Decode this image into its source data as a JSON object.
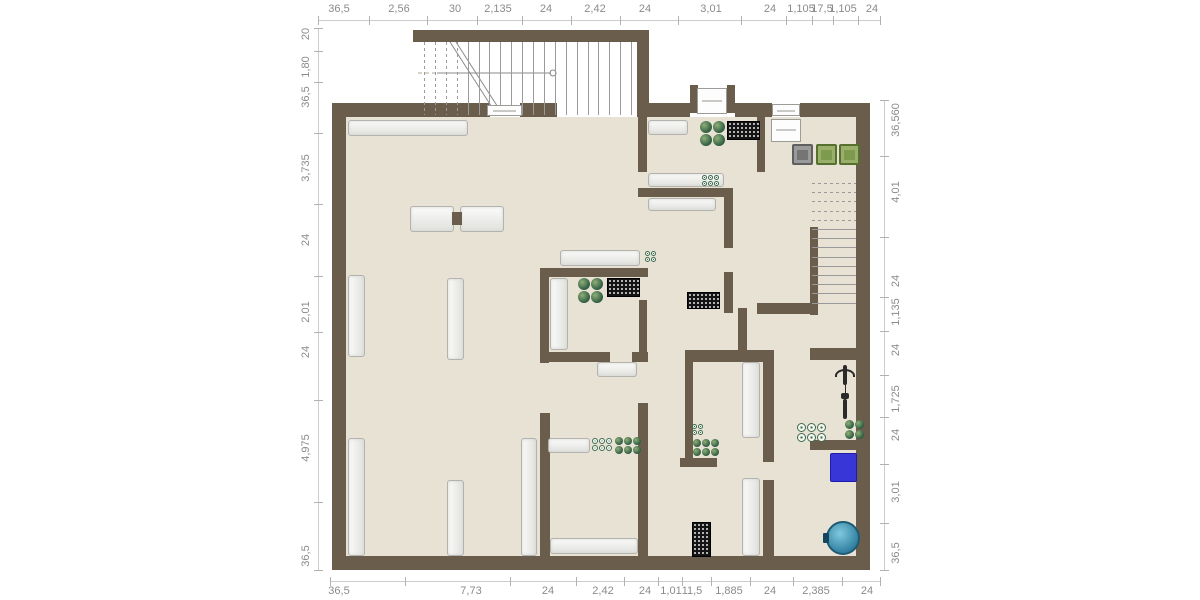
{
  "meta": {
    "watermark": "Illustration@ImmoGrafik"
  },
  "colors": {
    "wall": "#6a5d4b",
    "floor": "#e7e2d4",
    "dim_text": "#8b8b8b",
    "plant_green": "#2e5c41",
    "mat_black": "#141414",
    "chair_gray": "#7d7d7d",
    "chair_green": "#7e9a4e",
    "tank_blue": "#3936d8",
    "barrel_teal": "#2e7d9e"
  },
  "dimensions": {
    "top": {
      "line": {
        "x1": 318,
        "x2": 880,
        "y": 20
      },
      "labels": [
        {
          "t": "36,5",
          "p": 339
        },
        {
          "t": "2,56",
          "p": 399
        },
        {
          "t": "30",
          "p": 455
        },
        {
          "t": "2,135",
          "p": 498
        },
        {
          "t": "24",
          "p": 546
        },
        {
          "t": "2,42",
          "p": 595
        },
        {
          "t": "24",
          "p": 645
        },
        {
          "t": "3,01",
          "p": 711
        },
        {
          "t": "24",
          "p": 770
        },
        {
          "t": "1,105",
          "p": 801
        },
        {
          "t": "17,5",
          "p": 822
        },
        {
          "t": "1,105",
          "p": 843
        },
        {
          "t": "24",
          "p": 872
        }
      ]
    },
    "bottom": {
      "line": {
        "x1": 330,
        "x2": 880,
        "y": 581
      },
      "labels": [
        {
          "t": "36,5",
          "p": 339
        },
        {
          "t": "7,73",
          "p": 471
        },
        {
          "t": "24",
          "p": 548
        },
        {
          "t": "2,42",
          "p": 603
        },
        {
          "t": "24",
          "p": 645
        },
        {
          "t": "1,01",
          "p": 671
        },
        {
          "t": "11,5",
          "p": 692
        },
        {
          "t": "1,885",
          "p": 729
        },
        {
          "t": "24",
          "p": 770
        },
        {
          "t": "2,385",
          "p": 816
        },
        {
          "t": "24",
          "p": 867
        }
      ]
    },
    "left": {
      "line": {
        "y1": 28,
        "y2": 570,
        "x": 318
      },
      "labels": [
        {
          "t": "20",
          "p": 34
        },
        {
          "t": "1,80",
          "p": 67
        },
        {
          "t": "36,5",
          "p": 97
        },
        {
          "t": "3,735",
          "p": 168
        },
        {
          "t": "24",
          "p": 240
        },
        {
          "t": "2,01",
          "p": 312
        },
        {
          "t": "24",
          "p": 352
        },
        {
          "t": "4,975",
          "p": 448
        },
        {
          "t": "36,5",
          "p": 556
        }
      ]
    },
    "right": {
      "line": {
        "y1": 100,
        "y2": 570,
        "x": 884
      },
      "labels": [
        {
          "t": "36,560",
          "p": 120
        },
        {
          "t": "4,01",
          "p": 192
        },
        {
          "t": "24",
          "p": 281
        },
        {
          "t": "1,135",
          "p": 312
        },
        {
          "t": "24",
          "p": 350
        },
        {
          "t": "1,725",
          "p": 399
        },
        {
          "t": "24",
          "p": 435
        },
        {
          "t": "3,01",
          "p": 492
        },
        {
          "t": "36,5",
          "p": 553
        }
      ]
    }
  },
  "plan": {
    "floor": [
      [
        346,
        117,
        510,
        439
      ]
    ],
    "walls": [
      [
        332,
        103,
        14,
        467
      ],
      [
        332,
        556,
        538,
        14
      ],
      [
        856,
        103,
        14,
        467
      ],
      [
        332,
        103,
        158,
        14
      ],
      [
        520,
        103,
        37,
        14
      ],
      [
        637,
        103,
        53,
        14
      ],
      [
        735,
        103,
        37,
        14
      ],
      [
        800,
        103,
        56,
        14
      ],
      [
        413,
        30,
        236,
        12
      ],
      [
        637,
        42,
        12,
        75
      ],
      [
        690,
        85,
        8,
        28
      ],
      [
        727,
        85,
        8,
        28
      ],
      [
        638,
        117,
        9,
        55
      ],
      [
        638,
        188,
        95,
        9
      ],
      [
        724,
        188,
        9,
        60
      ],
      [
        724,
        272,
        9,
        41
      ],
      [
        540,
        268,
        108,
        9
      ],
      [
        540,
        268,
        9,
        95
      ],
      [
        548,
        352,
        62,
        10
      ],
      [
        632,
        352,
        16,
        10
      ],
      [
        639,
        300,
        8,
        52
      ],
      [
        540,
        413,
        10,
        143
      ],
      [
        638,
        403,
        10,
        153
      ],
      [
        685,
        350,
        89,
        12
      ],
      [
        685,
        362,
        8,
        98
      ],
      [
        680,
        458,
        37,
        9
      ],
      [
        763,
        350,
        11,
        112
      ],
      [
        763,
        480,
        11,
        76
      ],
      [
        810,
        348,
        46,
        12
      ],
      [
        810,
        440,
        46,
        10
      ],
      [
        757,
        303,
        61,
        11
      ],
      [
        810,
        227,
        8,
        88
      ],
      [
        757,
        117,
        8,
        55
      ],
      [
        738,
        308,
        9,
        46
      ]
    ],
    "furniture": [
      {
        "x": 348,
        "y": 120,
        "w": 120,
        "h": 16
      },
      {
        "x": 410,
        "y": 206,
        "w": 44,
        "h": 26
      },
      {
        "x": 460,
        "y": 206,
        "w": 44,
        "h": 26
      },
      {
        "x": 348,
        "y": 275,
        "w": 17,
        "h": 82,
        "v": 1
      },
      {
        "x": 447,
        "y": 278,
        "w": 17,
        "h": 82,
        "v": 1
      },
      {
        "x": 348,
        "y": 438,
        "w": 17,
        "h": 118,
        "v": 1
      },
      {
        "x": 447,
        "y": 480,
        "w": 17,
        "h": 76,
        "v": 1
      },
      {
        "x": 521,
        "y": 438,
        "w": 16,
        "h": 118,
        "v": 1
      },
      {
        "x": 550,
        "y": 538,
        "w": 88,
        "h": 16
      },
      {
        "x": 548,
        "y": 438,
        "w": 42,
        "h": 15
      },
      {
        "x": 560,
        "y": 250,
        "w": 80,
        "h": 16
      },
      {
        "x": 550,
        "y": 278,
        "w": 18,
        "h": 72,
        "v": 1
      },
      {
        "x": 648,
        "y": 120,
        "w": 40,
        "h": 15
      },
      {
        "x": 648,
        "y": 173,
        "w": 76,
        "h": 14
      },
      {
        "x": 648,
        "y": 198,
        "w": 68,
        "h": 13
      },
      {
        "x": 597,
        "y": 362,
        "w": 40,
        "h": 15
      },
      {
        "x": 742,
        "y": 362,
        "w": 18,
        "h": 76,
        "v": 1
      },
      {
        "x": 742,
        "y": 478,
        "w": 18,
        "h": 78,
        "v": 1
      }
    ],
    "island_link": {
      "x": 452,
      "y": 212,
      "w": 10,
      "h": 13
    },
    "fixtures": [
      {
        "x": 487,
        "y": 105,
        "w": 35,
        "h": 11
      },
      {
        "x": 697,
        "y": 88,
        "w": 30,
        "h": 26
      },
      {
        "x": 772,
        "y": 104,
        "w": 28,
        "h": 12
      },
      {
        "x": 771,
        "y": 119,
        "w": 30,
        "h": 23
      }
    ],
    "mats": [
      {
        "x": 727,
        "y": 121,
        "w": 31,
        "h": 17
      },
      {
        "x": 607,
        "y": 278,
        "w": 31,
        "h": 17
      },
      {
        "x": 687,
        "y": 292,
        "w": 31,
        "h": 15
      },
      {
        "x": 692,
        "y": 522,
        "w": 17,
        "h": 33
      }
    ],
    "plants": [
      {
        "x": 700,
        "y": 121,
        "rows": 2,
        "cols": 2,
        "size": 12,
        "variant": "dark"
      },
      {
        "x": 578,
        "y": 278,
        "rows": 2,
        "cols": 2,
        "size": 12,
        "variant": "dark"
      },
      {
        "x": 693,
        "y": 439,
        "rows": 2,
        "cols": 3,
        "size": 8,
        "variant": "dark"
      },
      {
        "x": 615,
        "y": 437,
        "rows": 2,
        "cols": 3,
        "size": 8,
        "variant": "dark"
      },
      {
        "x": 845,
        "y": 420,
        "rows": 2,
        "cols": 2,
        "size": 9,
        "variant": "dark"
      },
      {
        "x": 692,
        "y": 424,
        "rows": 2,
        "cols": 2,
        "size": 5,
        "variant": "light"
      },
      {
        "x": 702,
        "y": 175,
        "rows": 2,
        "cols": 3,
        "size": 5,
        "variant": "light"
      },
      {
        "x": 645,
        "y": 251,
        "rows": 2,
        "cols": 2,
        "size": 5,
        "variant": "light"
      },
      {
        "x": 592,
        "y": 438,
        "rows": 2,
        "cols": 3,
        "size": 6,
        "variant": "light"
      },
      {
        "x": 797,
        "y": 423,
        "rows": 2,
        "cols": 3,
        "size": 9,
        "variant": "light"
      }
    ],
    "chairs": [
      {
        "x": 792,
        "y": 144,
        "s": 21,
        "color": "gray"
      },
      {
        "x": 816,
        "y": 144,
        "s": 21,
        "color": "green"
      },
      {
        "x": 839,
        "y": 144,
        "s": 21,
        "color": "green"
      }
    ],
    "stairs_top": {
      "xStart": 424,
      "step": 10.9,
      "count": 20,
      "y": 42,
      "h": 73,
      "dashedFirst": 4
    },
    "stairs_right": {
      "yStart": 183,
      "step": 9.2,
      "count": 14,
      "x": 812,
      "w": 44,
      "dashedFirst": 5
    },
    "tank": {
      "x": 830,
      "y": 453,
      "w": 25,
      "h": 27
    },
    "barrel": {
      "x": 826,
      "y": 521,
      "d": 34
    },
    "bike": {
      "x": 836,
      "y": 363
    },
    "arcs": [
      "M562,118 A40,40 0 0 1 598,158",
      "M634,118 A40,40 0 0 0 598,158",
      "M700,117 A27,27 0 0 1 713,142",
      "M727,117 A27,27 0 0 0 713,142",
      "M647,165 A26,26 0 0 1 673,191",
      "M765,168 A25,25 0 0 1 790,193",
      "M612,352 A26,26 0 0 1 638,326",
      "M617,403 A26,26 0 0 0 643,377",
      "M545,383 A30,30 0 0 1 575,413",
      "M693,462 A24,24 0 0 0 717,486",
      "M774,458 A22,22 0 0 1 796,480",
      "M802,313 A54,46 0 0 0 856,359",
      "M698,250 A26,26 0 0 0 724,274",
      "M418,73 L437,73"
    ],
    "lines": [
      "M450,42 L497,115",
      "M456,42 L503,115",
      "M437,73 L551,73",
      "M556,73 A3,3 0 1 0 550,73 A3,3 0 1 0 556,73",
      "M812,303 L856,205",
      "M836,454 L836,444 L852,444 M845,444 L845,454"
    ]
  }
}
